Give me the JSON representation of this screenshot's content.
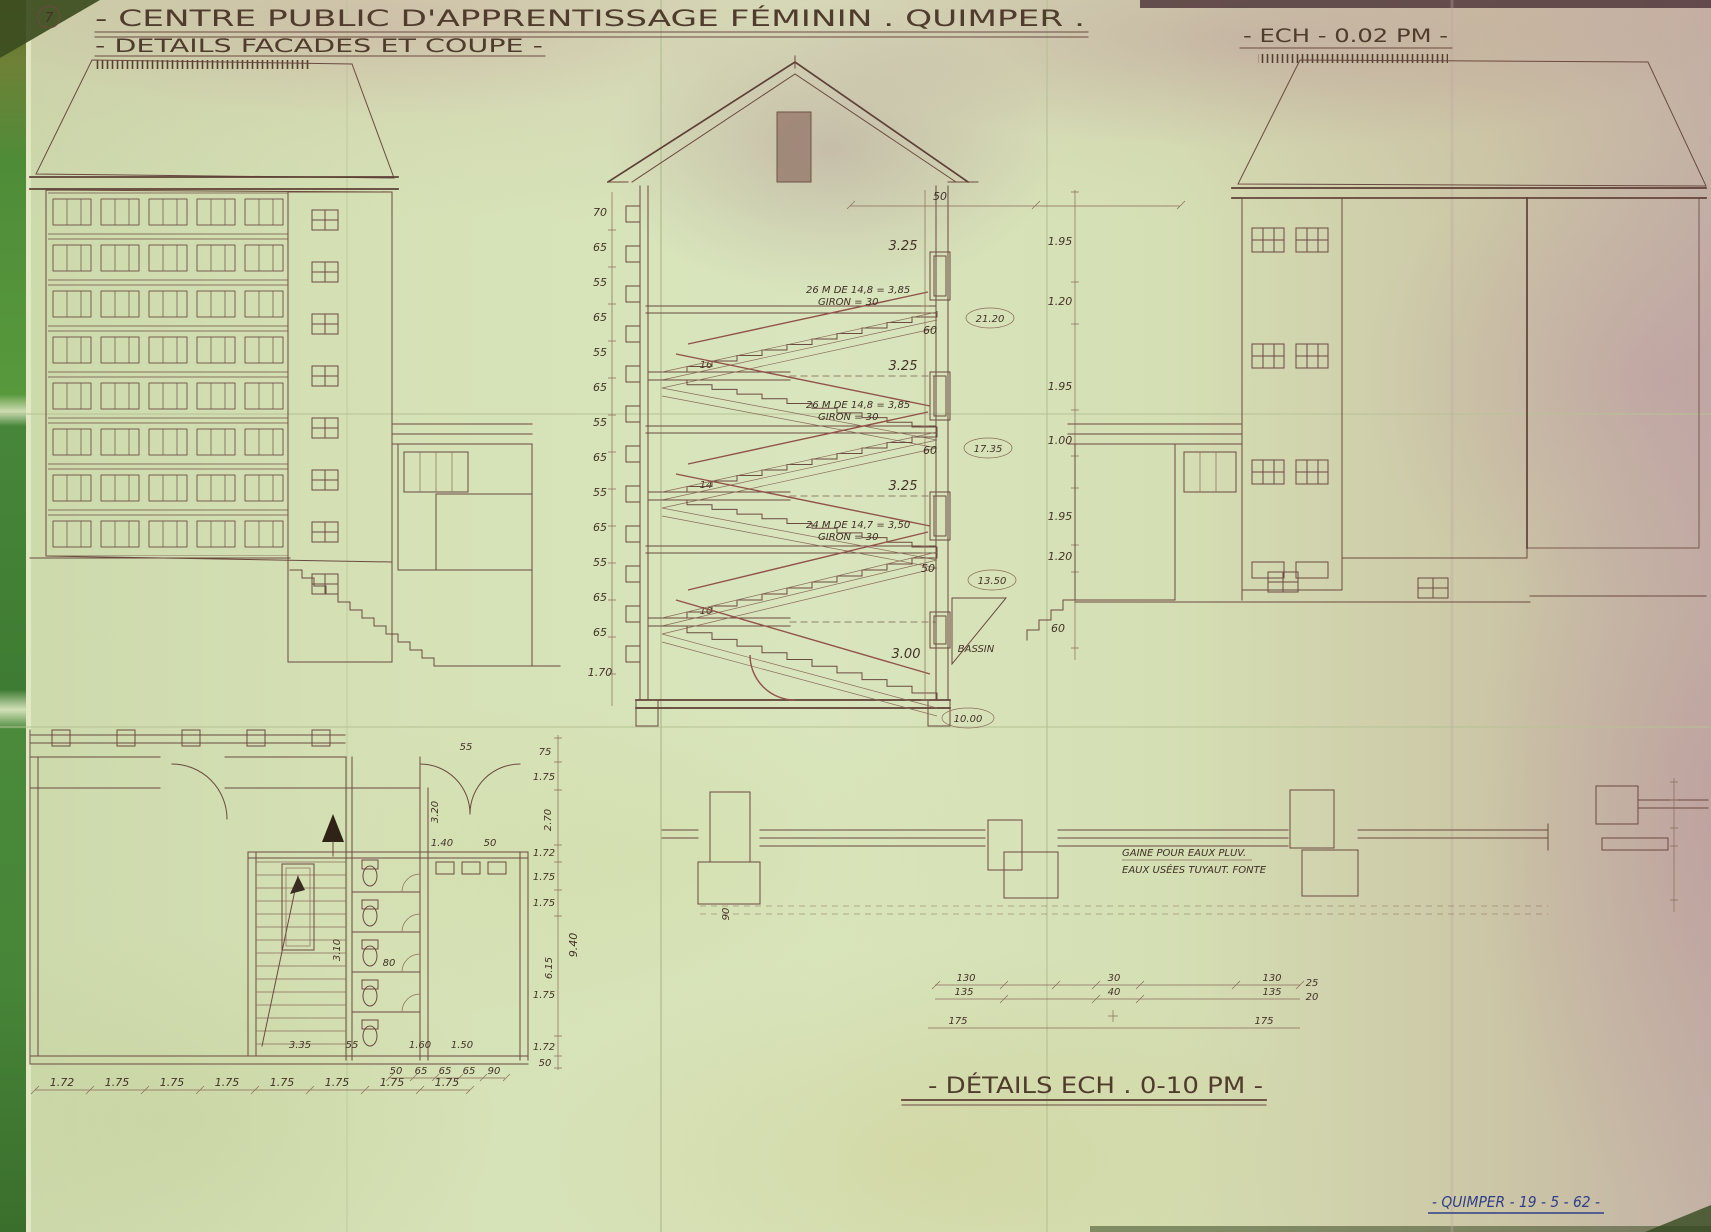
{
  "sheet": {
    "number": "7",
    "title": "- CENTRE PUBLIC D'APPRENTISSAGE FÉMININ . QUIMPER .",
    "subtitle": "- DETAILS FACADES ET COUPE -",
    "scale_main": "- ECH - 0.02 PM -",
    "details_title": "- DÉTAILS   ECH . 0-10 PM -",
    "signature": "- QUIMPER - 19 - 5 - 62 -"
  },
  "section": {
    "left_dims": [
      "70",
      "65",
      "55",
      "65",
      "55",
      "65",
      "55",
      "65",
      "55",
      "65",
      "55",
      "65",
      "65",
      "1.70"
    ],
    "storey_dims": [
      "3.25",
      "3.25",
      "3.25",
      "3.00"
    ],
    "slab_dims": [
      "60",
      "60",
      "50"
    ],
    "top_dim": "50",
    "right_chain": [
      "1.95",
      "1.20",
      "1.95",
      "1.00",
      "1.95",
      "1.20",
      "60"
    ],
    "levels": [
      "21.20",
      "17.35",
      "13.50",
      "10.00"
    ],
    "landings": [
      "16",
      "14",
      "10"
    ],
    "stair_notes": [
      {
        "l1": "26 M DE 14,8 = 3,85",
        "l2": "GIRON = 30"
      },
      {
        "l1": "26 M DE 14,8 = 3,85",
        "l2": "GIRON = 30"
      },
      {
        "l1": "24 M DE 14,7 = 3,50",
        "l2": "GIRON = 30"
      }
    ],
    "bassin": "BASSIN"
  },
  "plan": {
    "bottom_chain": [
      "1.72",
      "1.75",
      "1.75",
      "1.75",
      "1.75",
      "1.75",
      "1.75",
      "1.75"
    ],
    "mid_dims": [
      "3.35",
      "55",
      "1.60",
      "1.50"
    ],
    "stall_dims": [
      "50",
      "65",
      "65",
      "65",
      "90"
    ],
    "right_chain": [
      "75",
      "1.75",
      "2.70",
      "1.72",
      "1.75",
      "1.75",
      "9.40",
      "6.15",
      "1.75",
      "1.72",
      "50"
    ],
    "labels": {
      "top": "55",
      "door_w": "3.20",
      "w140": "1.40",
      "w50": "50",
      "stair_run": "3.10",
      "w80": "80"
    }
  },
  "details": {
    "note1": "GAINE POUR EAUX PLUV.",
    "note2": "EAUX USÉES TUYAUT. FONTE",
    "left_dims": [
      "130",
      "135",
      "175"
    ],
    "center_dims": [
      "30",
      "40"
    ],
    "right_dims": [
      "130",
      "135",
      "175"
    ],
    "rot_dim": "90",
    "right_small": [
      "25",
      "20"
    ]
  }
}
